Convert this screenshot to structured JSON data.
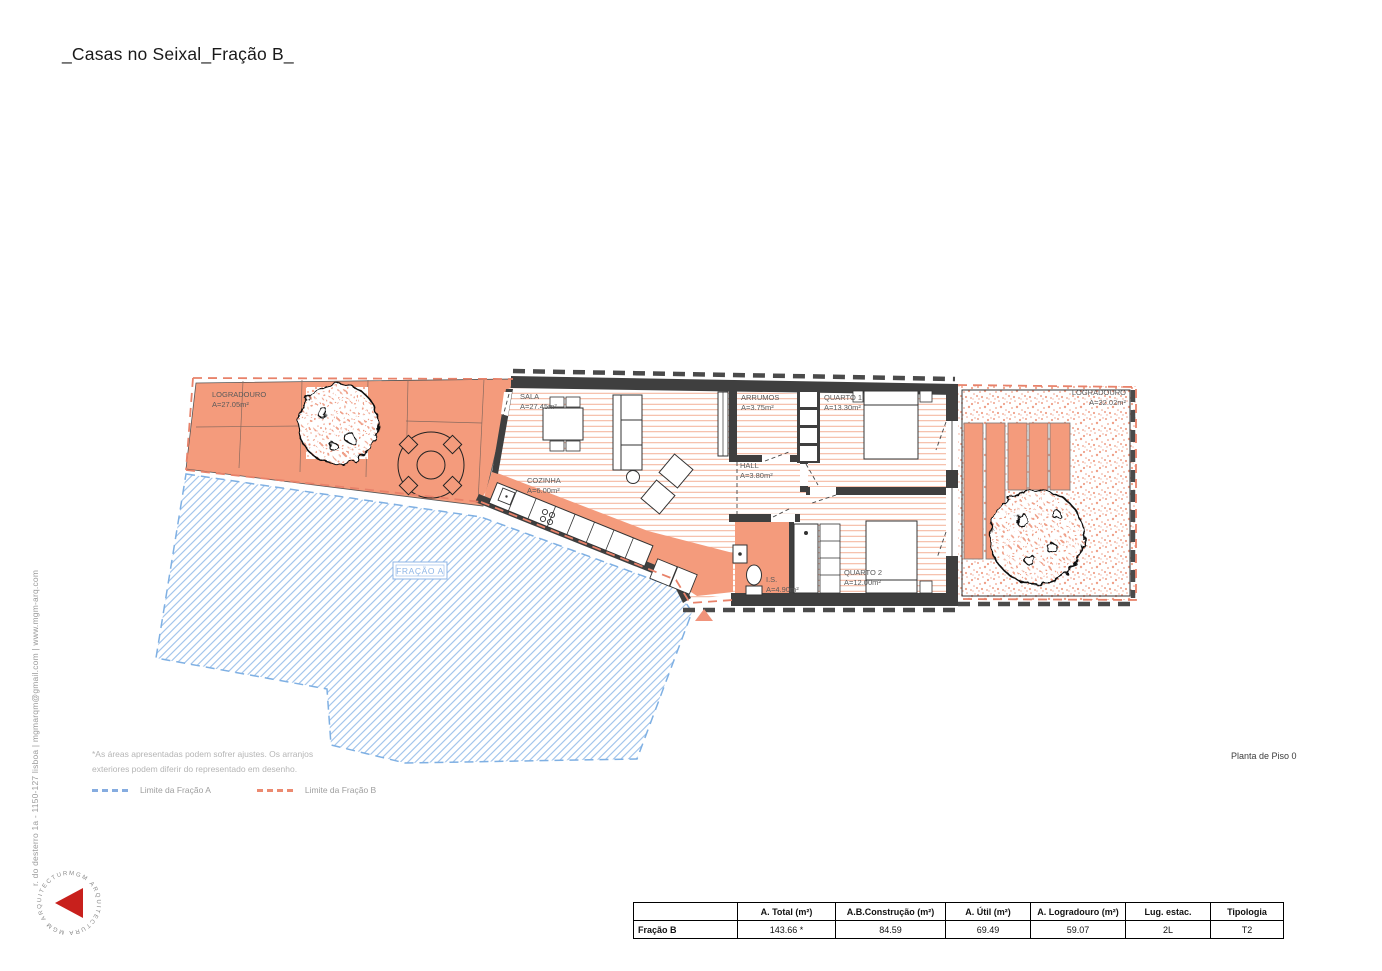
{
  "title": "_Casas no Seixal_Fração B_",
  "address_vertical": "r. do desterro 1a - 1150-127 lisboa | mgmarqm@gmail.com | www.mgm-arq.com",
  "logo": {
    "ring_text": "MGM ARQUITECTURA   MGM ARQUITECTURA"
  },
  "plan": {
    "rooms": {
      "logradouro_left": {
        "name": "LOGRADOURO",
        "area": "A=27.05m²"
      },
      "sala": {
        "name": "SALA",
        "area": "A=27.45m²"
      },
      "cozinha": {
        "name": "COZINHA",
        "area": "A=6.00m²"
      },
      "arrumos": {
        "name": "ARRUMOS",
        "area": "A=3.75m²"
      },
      "quarto1": {
        "name": "QUARTO 1",
        "area": "A=13.30m²"
      },
      "hall": {
        "name": "HALL",
        "area": "A=3.80m²"
      },
      "is": {
        "name": "I.S.",
        "area": "A=4.90m²"
      },
      "quarto2": {
        "name": "QUARTO 2",
        "area": "A=12.00m²"
      },
      "logradouro_right": {
        "name": "LOGRADOURO",
        "area": "A=32.02m²"
      },
      "fracao_a": {
        "name": "FRAÇÃO A"
      }
    },
    "colors": {
      "logradouro_fill": "#F49B7C",
      "wall": "#3F3F3F",
      "limit_fracao_a": "#7FB0E3",
      "limit_fracao_b": "#E8826A",
      "floor_hatch": "#F2A78C",
      "blue_hatch": "#A5C6EC",
      "logo_red": "#C8201C"
    }
  },
  "notes": {
    "line1": "*As áreas apresentadas podem sofrer ajustes. Os arranjos",
    "line2": "exteriores podem diferir do representado em desenho."
  },
  "legend": {
    "fracao_a_label": "Limite da Fração A",
    "fracao_b_label": "Limite da Fração B"
  },
  "drawing_title": "Planta de Piso 0",
  "table": {
    "headers": [
      "",
      "A. Total (m²)",
      "A.B.Construção (m²)",
      "A. Útil (m²)",
      "A. Logradouro (m²)",
      "Lug. estac.",
      "Tipologia"
    ],
    "rows": [
      [
        "Fração B",
        "143.66 *",
        "84.59",
        "69.49",
        "59.07",
        "2L",
        "T2"
      ]
    ]
  }
}
